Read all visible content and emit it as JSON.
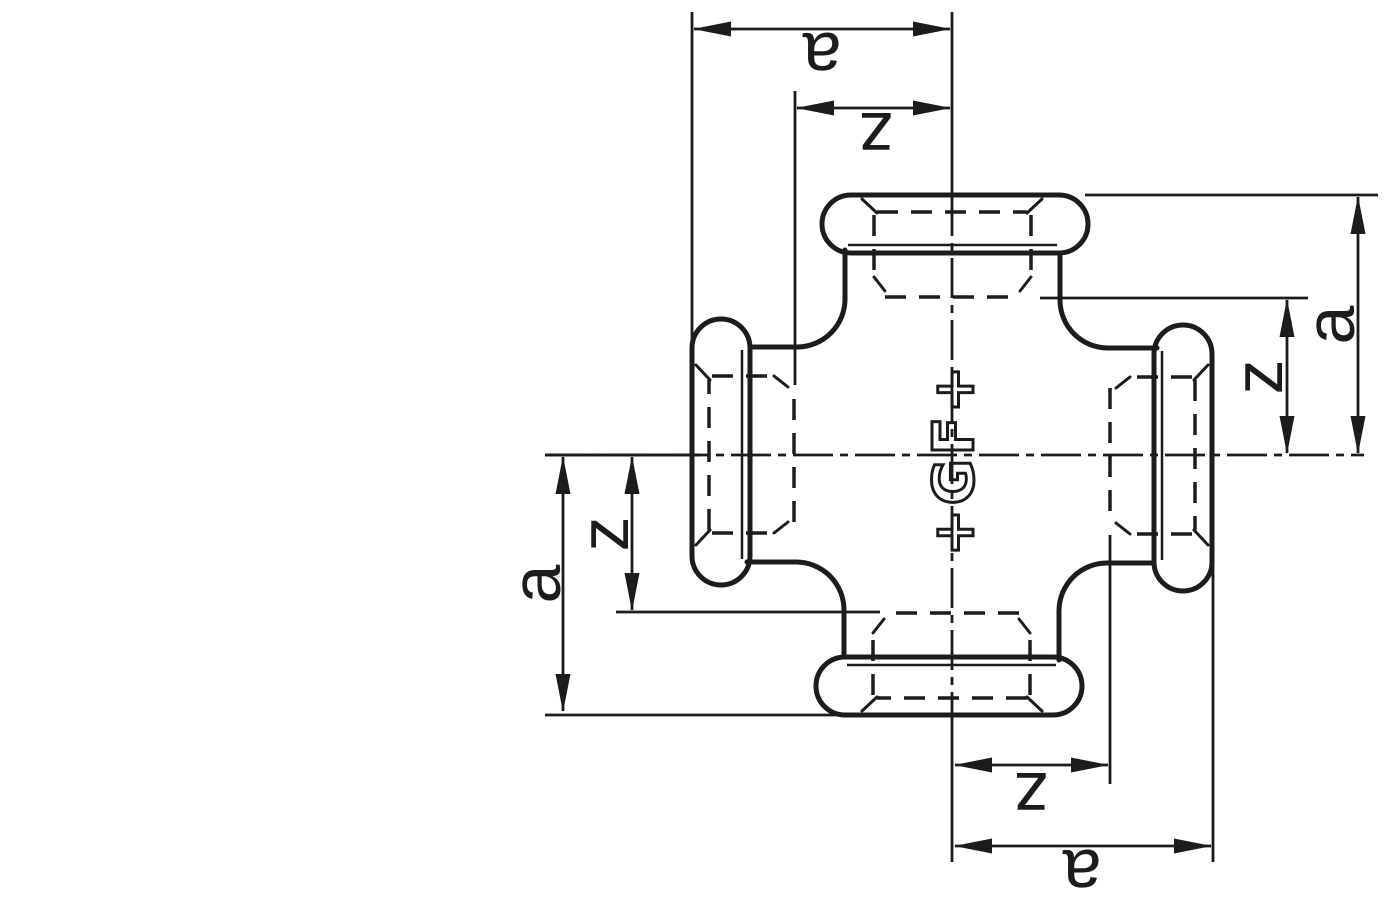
{
  "colors": {
    "ink": "#1c1c1c",
    "background": "#ffffff"
  },
  "dimensions": {
    "top": {
      "outer": "a",
      "inner": "z"
    },
    "right": {
      "outer": "a",
      "inner": "z"
    },
    "bottom": {
      "outer": "a",
      "inner": "z"
    },
    "left": {
      "outer": "a",
      "inner": "z"
    }
  },
  "logo": {
    "mark": "+GF+"
  }
}
